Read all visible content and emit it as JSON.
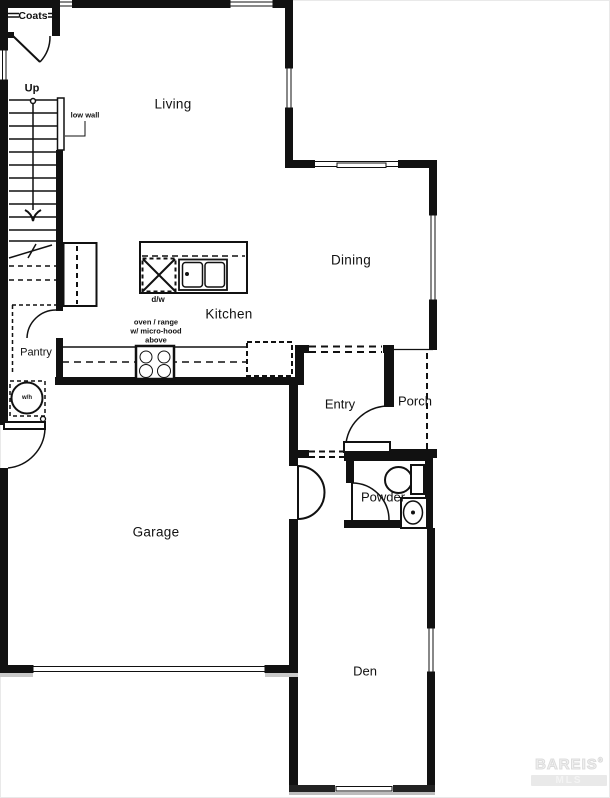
{
  "floor_plan": {
    "rooms": {
      "coats": {
        "label": "Coats"
      },
      "living": {
        "label": "Living"
      },
      "dining": {
        "label": "Dining"
      },
      "kitchen": {
        "label": "Kitchen"
      },
      "pantry": {
        "label": "Pantry"
      },
      "entry": {
        "label": "Entry"
      },
      "porch": {
        "label": "Porch"
      },
      "garage": {
        "label": "Garage"
      },
      "powder": {
        "label": "Powder"
      },
      "den": {
        "label": "Den"
      }
    },
    "annotations": {
      "stairs_up": "Up",
      "low_wall": "low wall",
      "dishwasher": "d/w",
      "range_note_line1": "oven / range",
      "range_note_line2": "w/ micro-hood",
      "range_note_line3": "above",
      "water_heater": "w/h"
    },
    "watermark": {
      "line1": "BAREIS",
      "reg_mark": "®",
      "line2": "MLS"
    },
    "colors": {
      "wall": "#111111",
      "background": "#ffffff",
      "watermark_text": "#e4e4e4"
    }
  }
}
